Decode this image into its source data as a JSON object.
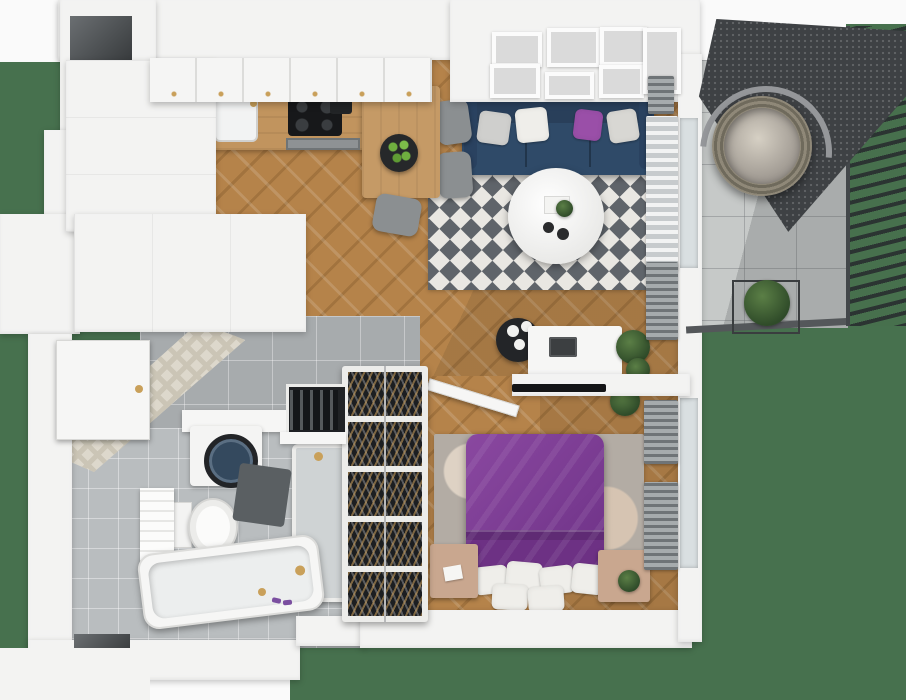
{
  "scene": {
    "type": "3d-apartment-floor-plan-top-view",
    "rooms": {
      "kitchen": {
        "label": "Kitchen"
      },
      "living_room": {
        "label": "Living room"
      },
      "hallway": {
        "label": "Hallway"
      },
      "bathroom": {
        "label": "Bathroom"
      },
      "bedroom": {
        "label": "Bedroom"
      },
      "balcony": {
        "label": "Balcony"
      },
      "lawn": {
        "label": "Lawn"
      }
    },
    "palette": {
      "lawn_green": "#47714e",
      "wood_floor": "#b5834a",
      "counter_wood": "#c1945e",
      "wall_white": "#f3f3f2",
      "hall_tile_gray": "#a7abad",
      "bath_tile_gray": "#b9bdbf",
      "balcony_tile": "#c6c9c8",
      "sofa_navy": "#2f4a68",
      "bed_purple": "#7d3d92",
      "accent_purple": "#9a4fa8",
      "brass_gold": "#c9a05a",
      "canopy_mesh": "#3e4144",
      "nightstand_tan": "#c9a78f"
    },
    "furniture": {
      "kitchen": [
        "upper cabinet row with brass knobs",
        "tall cabinet column",
        "wood countertop with sink",
        "black induction cooktop",
        "oven front",
        "coffee maker",
        "wood dining table",
        "fruit bowl with green apples",
        "3 gray chairs"
      ],
      "living_room": [
        "gallery wall with 7 frames",
        "navy 3-seat sofa",
        "4 throw pillows (gray, white, purple, silver)",
        "black & white diamond rug",
        "round white coffee table with plant and cups",
        "black side table with sphere lamps",
        "white desk with laptop",
        "gray desk chair",
        "wall TV",
        "potted plants",
        "window radiators"
      ],
      "hallway": [
        "built-in wardrobe",
        "entrance door with brass knob",
        "tall wine rack with 5 shelves",
        "small bottle rack"
      ],
      "bathroom": [
        "chevron tiled wall",
        "washing machine under counter",
        "wall-hung toilet",
        "white tiled half wall",
        "walk-in shower with brass head",
        "bathtub with brass faucet",
        "dark bath mat",
        "purple slippers"
      ],
      "bedroom": [
        "double bed with purple duvet",
        "6 white pillows",
        "2 tan nightstands",
        "mottled gray rug",
        "open interior door",
        "2 gray radiators",
        "potted plant"
      ],
      "balcony": [
        "hanging egg chair with stand",
        "dark mesh canopy",
        "slatted privacy fence",
        "metal plant stand with shrub",
        "stone tile floor",
        "edge railing"
      ]
    }
  }
}
